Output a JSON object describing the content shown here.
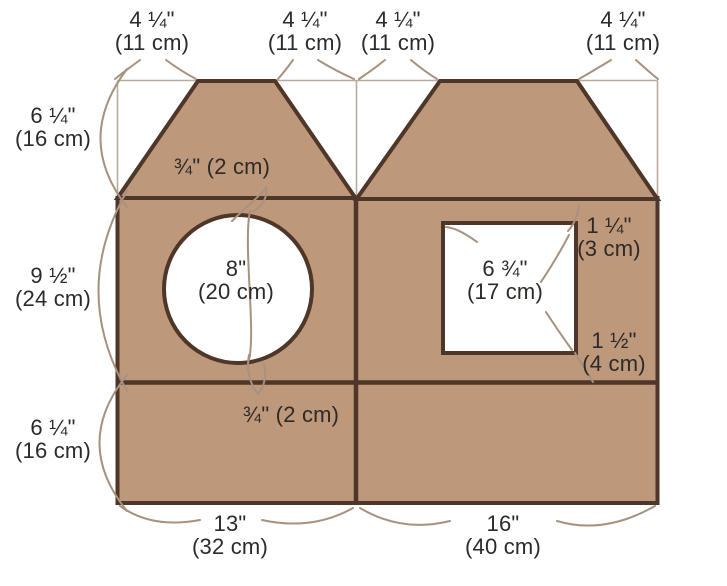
{
  "colors": {
    "background": "#ffffff",
    "cardboard": "#be987a",
    "outline": "#4e3628",
    "guide": "#b8ab9e",
    "leader": "#a8917e",
    "text": "#2d2a28"
  },
  "labels": {
    "top": [
      {
        "in": "4 ¼\"",
        "cm": "(11 cm)"
      },
      {
        "in": "4 ¼\"",
        "cm": "(11 cm)"
      },
      {
        "in": "4 ¼\"",
        "cm": "(11 cm)"
      },
      {
        "in": "4 ¼\"",
        "cm": "(11 cm)"
      }
    ],
    "left": [
      {
        "in": "6 ¼\"",
        "cm": "(16 cm)"
      },
      {
        "in": "9 ½\"",
        "cm": "(24 cm)"
      },
      {
        "in": "6 ¼\"",
        "cm": "(16 cm)"
      }
    ],
    "roof_fold": "¾\" (2 cm)",
    "base_fold": "¾\" (2 cm)",
    "circle_hole": {
      "in": "8\"",
      "cm": "(20 cm)"
    },
    "square_hole": {
      "in": "6 ¾\"",
      "cm": "(17 cm)"
    },
    "window_top": {
      "in": "1 ¼\"",
      "cm": "(3 cm)"
    },
    "window_bottom": {
      "in": "1 ½\"",
      "cm": "(4 cm)"
    },
    "bottom": [
      {
        "in": "13\"",
        "cm": "(32 cm)"
      },
      {
        "in": "16\"",
        "cm": "(40 cm)"
      }
    ]
  }
}
